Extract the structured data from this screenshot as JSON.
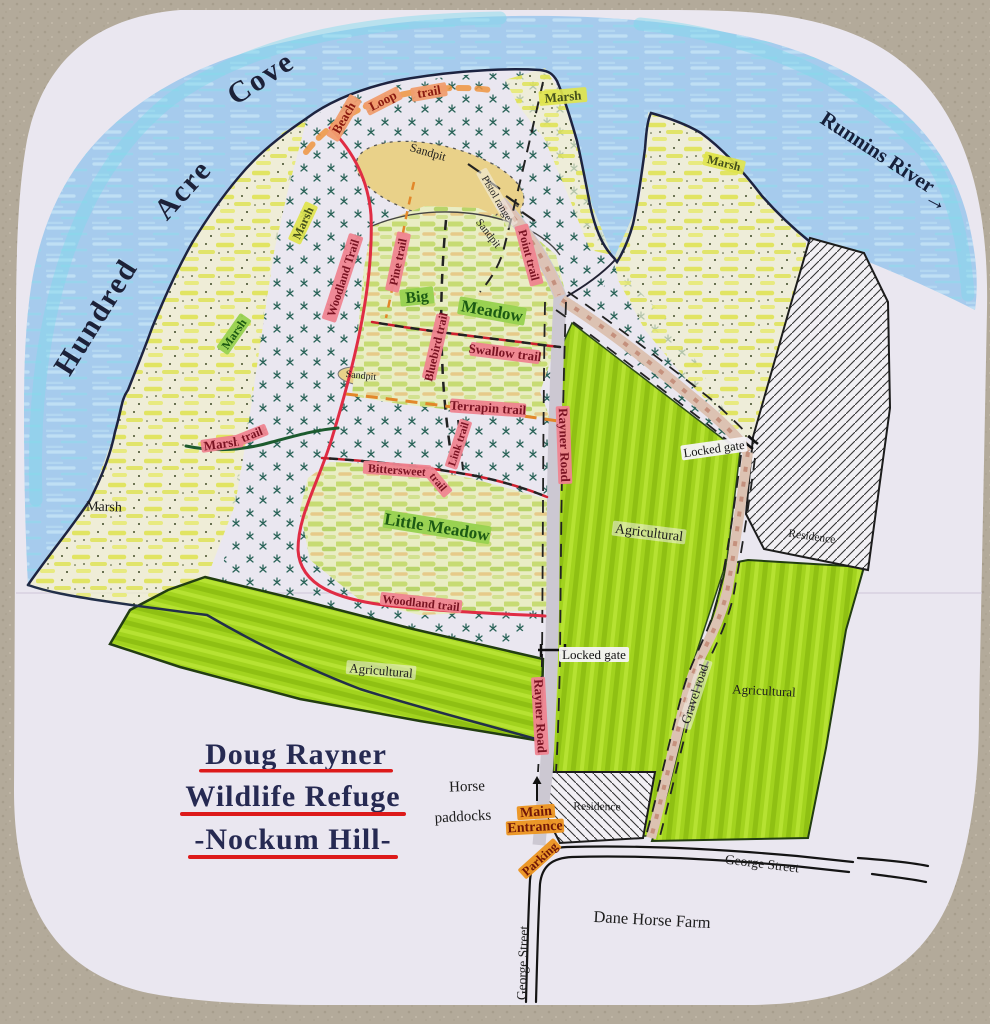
{
  "title": {
    "lines": [
      "Doug Rayner",
      "Wildlife Refuge",
      "-Nockum Hill-"
    ]
  },
  "water": {
    "cove_words": [
      "Hundred",
      "Acre",
      "Cove"
    ],
    "river_label": "Runnins River",
    "river_arrow": "→"
  },
  "marsh_labels": [
    "Marsh",
    "Marsh",
    "Marsh",
    "Marsh",
    "Marsh"
  ],
  "sandpit_labels": [
    "Sandpit",
    "Sandpit",
    "Sandpit"
  ],
  "trails": {
    "beach": "Beach",
    "loop": "Loop",
    "beach_trail_word": "trail",
    "woodland_upper": "Woodland Trail",
    "woodland_lower": "Woodland trail",
    "pine": "Pine trail",
    "point": "Point trail",
    "bluebird": "Bluebird trail",
    "swallow": "Swallow trail",
    "terrapin": "Terrapin trail",
    "link": "Link trail",
    "bittersweet_word": "Bittersweet",
    "bittersweet_trail_word": "trail",
    "marsh_word": "Marsh",
    "marsh_trail_word": "trail"
  },
  "meadows": {
    "big_word": "Big",
    "meadow_word": "Meadow",
    "little": "Little Meadow"
  },
  "roads": {
    "rayner": [
      "Rayner Road",
      "Rayner Road"
    ],
    "gravel": "Gravel road",
    "george": [
      "George Street",
      "George Street"
    ]
  },
  "zones": {
    "agricultural": [
      "Agricultural",
      "Agricultural",
      "Agricultural"
    ],
    "residence": [
      "Residence",
      "Residence"
    ],
    "pistol_range": "Pistol range"
  },
  "gates": {
    "locked": [
      "Locked gate",
      "Locked gate"
    ],
    "main_line1": "Main",
    "main_line2": "Entrance",
    "parking": "Parking",
    "arrow_up": "↑"
  },
  "places": {
    "horse_line1": "Horse",
    "horse_line2": "paddocks",
    "dane_farm": "Dane Horse Farm"
  },
  "colors": {
    "carpet": "#b3aa9a",
    "paper": "#eae7f0",
    "water": "#a6cbed",
    "water_accent": "#7edaeb",
    "ink_coast": "#1d2340",
    "marsh_yellow": "#e0e455",
    "woods_teal": "#2a6358",
    "meadow_green": "#c8dd6e",
    "sand": "#e9d189",
    "agricultural_green": "#a2d31e",
    "trail_highlight_pink": "#ef8490",
    "trail_red": "#e02c44",
    "trail_orange": "#e2872a",
    "entrance_orange": "#eb9522",
    "label_green": "#97d24f",
    "road_gray": "#ccc8d2",
    "gravel_road": "#dcc2b2",
    "title_navy": "#262a52",
    "underline_red": "#dd1a1a"
  }
}
